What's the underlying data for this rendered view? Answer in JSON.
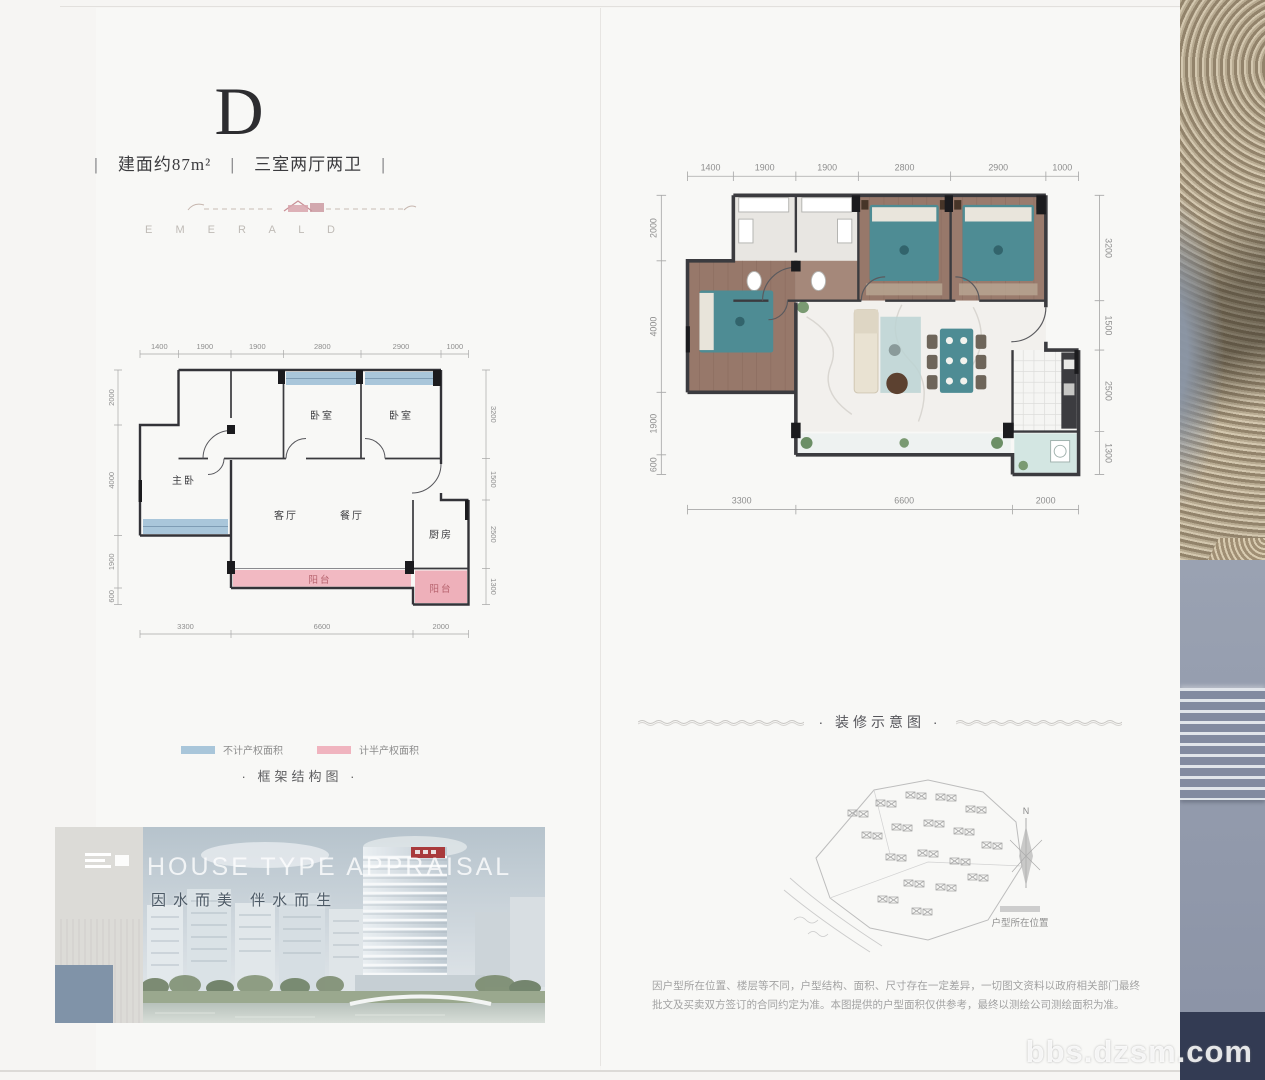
{
  "unit": {
    "type_label": "D",
    "area": "建面约87m²",
    "rooms": "三室两厅两卫",
    "divider": "|",
    "brand": "E M E R A L D"
  },
  "plan": {
    "dims_top": [
      "1400",
      "1900",
      "1900",
      "2800",
      "2900",
      "1000"
    ],
    "dims_bottom": [
      "3300",
      "6600",
      "2000"
    ],
    "dims_left": [
      "2000",
      "4000",
      "1900",
      "600"
    ],
    "dims_right": [
      "3200",
      "1500",
      "2500",
      "1300"
    ],
    "rooms": {
      "master": "主卧",
      "bedroom_a": "卧室",
      "bedroom_b": "卧室",
      "living": "客厅",
      "dining": "餐厅",
      "kitchen": "厨房",
      "balcony_main": "阳台",
      "balcony_side": "阳台"
    }
  },
  "legend": {
    "blue_label": "不计产权面积",
    "pink_label": "计半产权面积",
    "blue_color": "#a9c6da",
    "pink_color": "#f0b4bf"
  },
  "captions": {
    "structure": "· 框架结构图 ·",
    "decoration": "· 装修示意图 ·"
  },
  "photo": {
    "title": "HOUSE TYPE APPRAISAL",
    "slogan": "因水而美 伴水而生"
  },
  "siteplan": {
    "north": "N",
    "label": "户型所在位置"
  },
  "disclaimer": "因户型所在位置、楼层等不同，户型结构、面积、尺寸存在一定差异，一切图文资料以政府相关部门最终批文及买卖双方签订的合同约定为准。本图提供的户型面积仅供参考，最终以测绘公司测绘面积为准。",
  "watermark": "bbs.dzsm.com"
}
